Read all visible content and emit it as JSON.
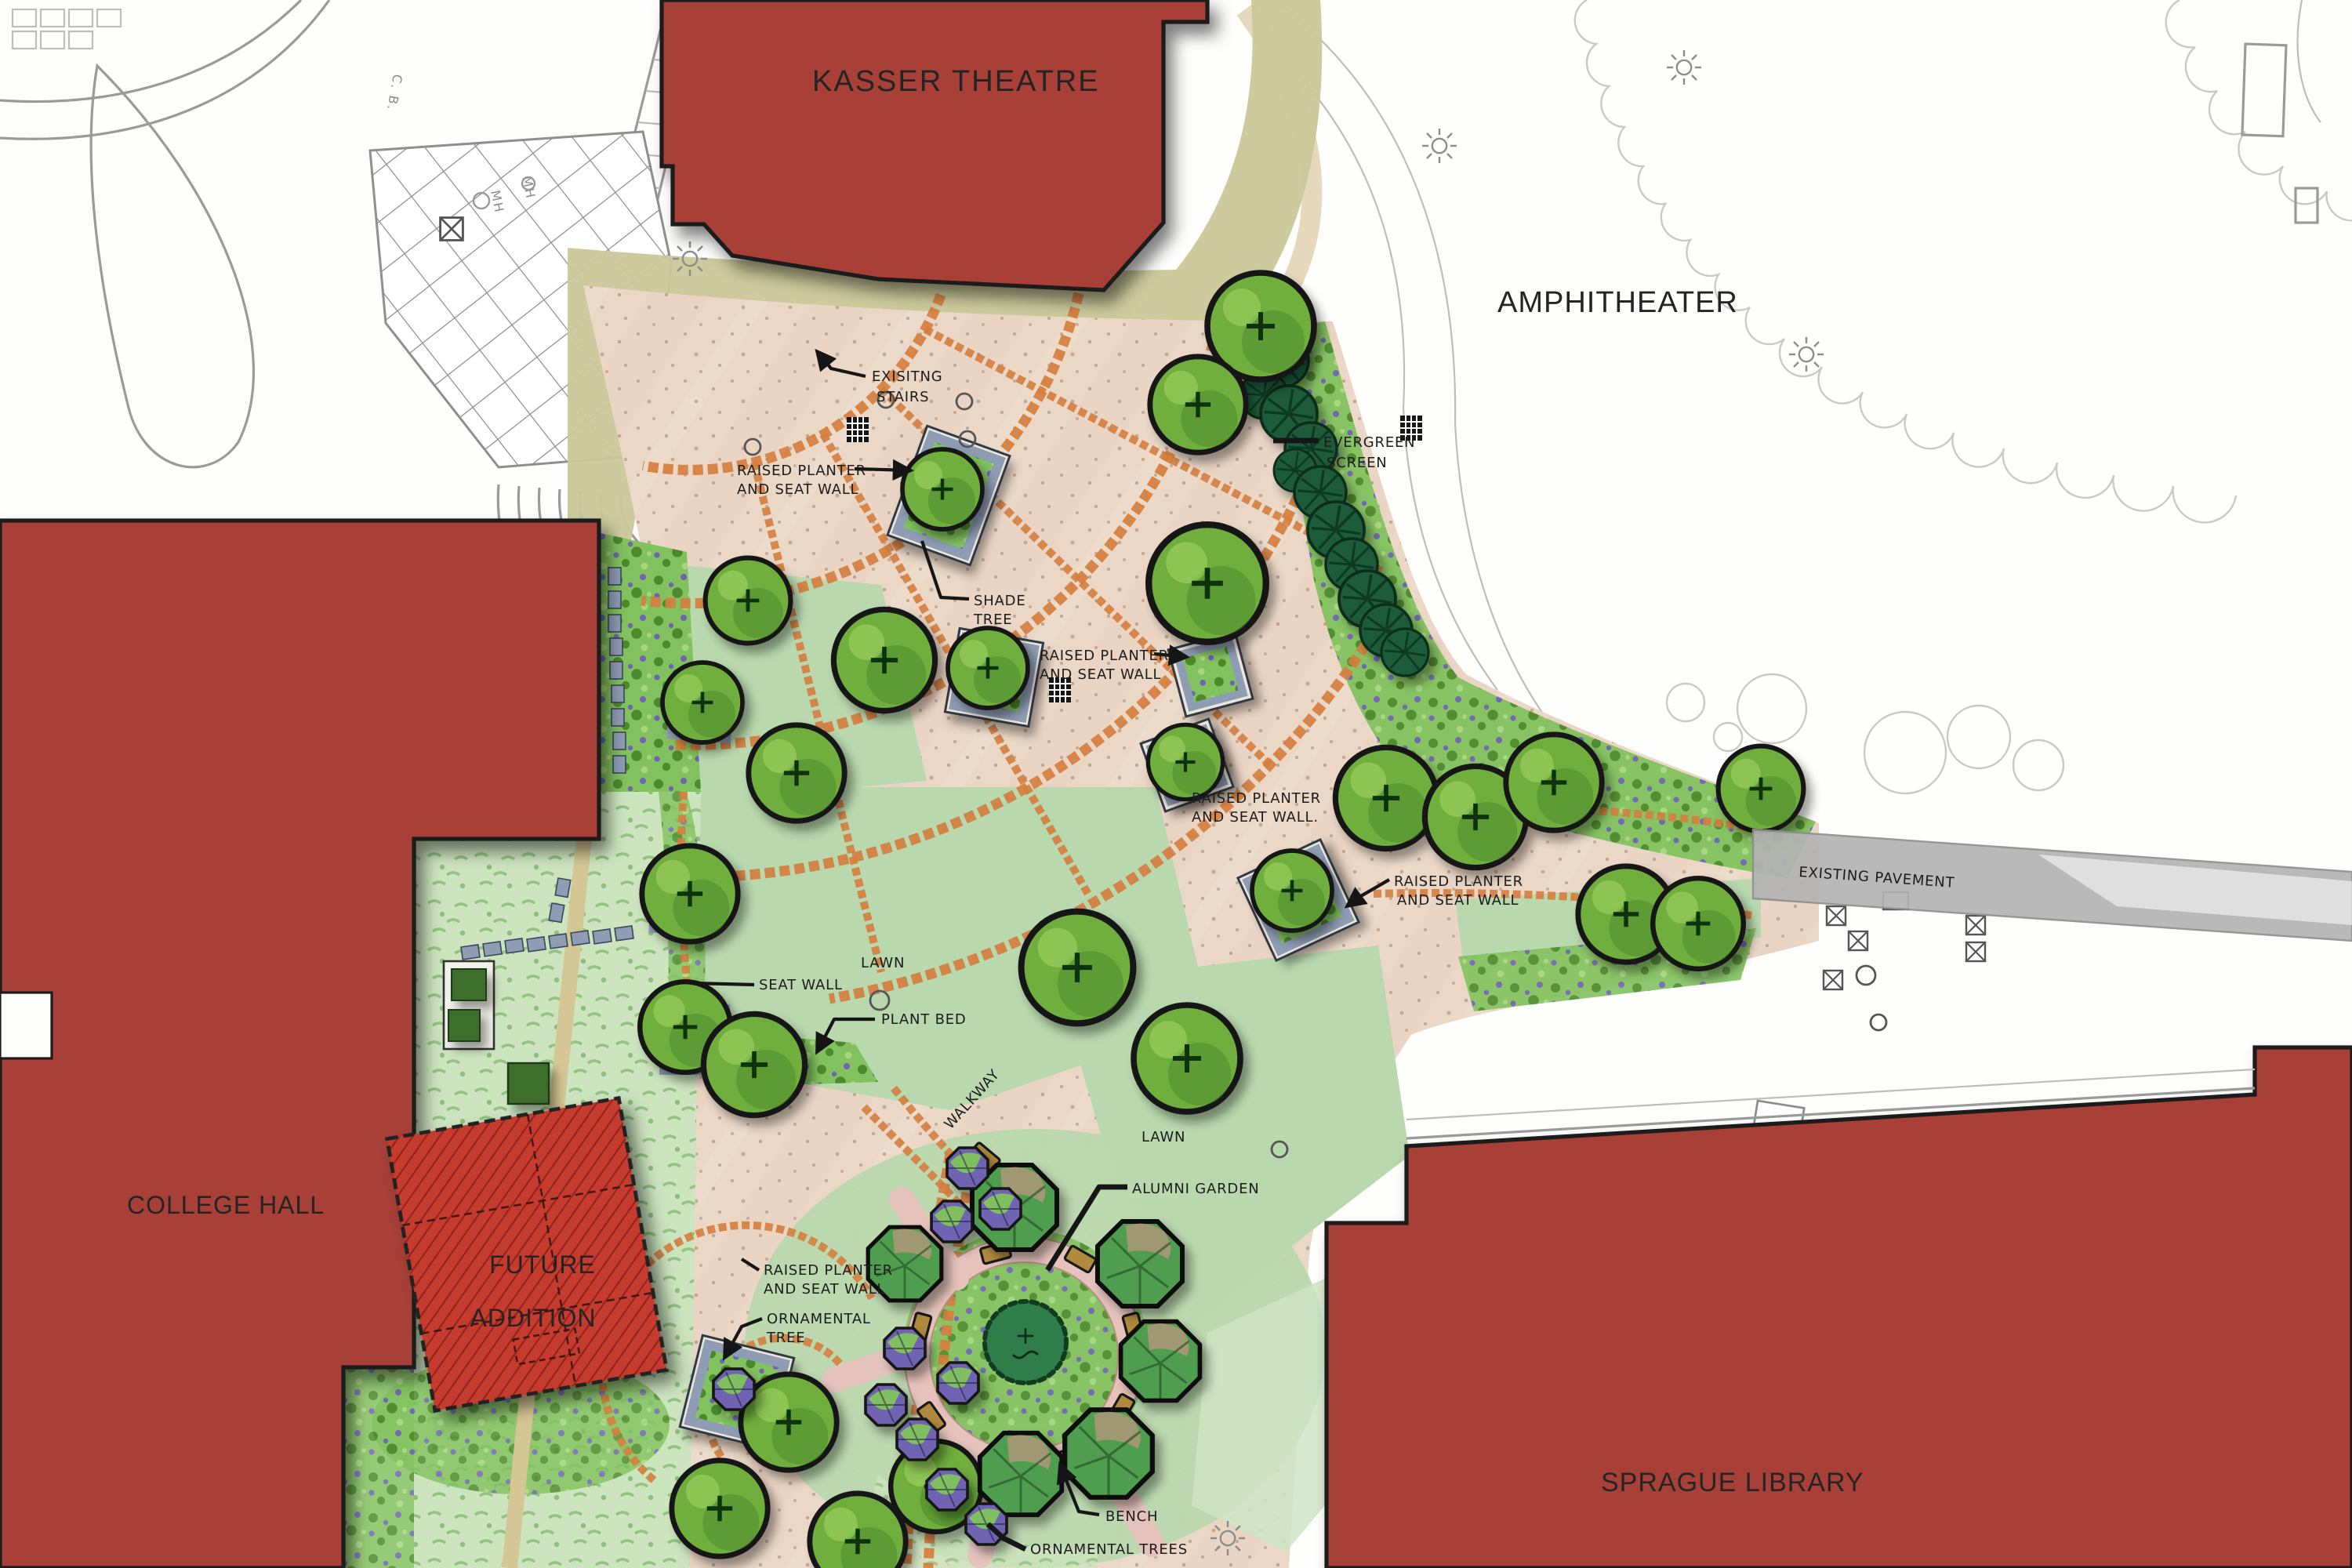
{
  "buildings": {
    "kasser_theatre": "KASSER THEATRE",
    "college_hall": "COLLEGE HALL",
    "future_addition": {
      "line1": "FUTURE",
      "line2": "ADDITION"
    },
    "sprague_library": "SPRAGUE LIBRARY"
  },
  "areas": {
    "amphitheater": "AMPHITHEATER",
    "existing_pavement": "EXISTING PAVEMENT",
    "lawn_upper": "LAWN",
    "lawn_lower": "LAWN",
    "walkway": "WALKWAY"
  },
  "callouts": {
    "existing_stairs": {
      "line1": "EXISITNG",
      "line2": "STAIRS"
    },
    "raised_planter_1": {
      "line1": "RAISED PLANTER",
      "line2": "AND SEAT WALL"
    },
    "shade_tree": {
      "line1": "SHADE",
      "line2": "TREE"
    },
    "raised_planter_2": {
      "line1": "RAISED PLANTER",
      "line2": "AND SEAT WALL"
    },
    "evergreen_screen": {
      "line1": "EVERGREEN",
      "line2": "SCREEN"
    },
    "raised_planter_3": {
      "line1": "RAISED PLANTER",
      "line2": "AND SEAT WALL."
    },
    "raised_planter_4": {
      "line1": "RAISED PLANTER",
      "line2": "AND SEAT WALL"
    },
    "seat_wall": "SEAT WALL",
    "plant_bed": "PLANT BED",
    "alumni_garden": "ALUMNI GARDEN",
    "raised_planter_5": {
      "line1": "RAISED PLANTER",
      "line2": "AND SEAT WALL"
    },
    "ornamental_tree": {
      "line1": "ORNAMENTAL",
      "line2": "TREE"
    },
    "bench": "BENCH",
    "ornamental_trees": "ORNAMENTAL TREES"
  },
  "survey_marks": {
    "cb": "C. B.",
    "mh_1": "MH",
    "mh_2": "MH"
  },
  "colors": {
    "building_red": "#a84038",
    "future_red": "#c53b2e",
    "brick_orange": "#d57e3e",
    "paving_tan": "#ead7c6",
    "paving_pink": "#e9c9ba",
    "lawn_green": "#b9d8ae",
    "meadow_green": "#cde5bf",
    "planting_green": "#82c25e",
    "tree_green": "#6fae3e",
    "tree_dark": "#4c8a2b",
    "evergreen_green": "#1e5c3a",
    "planter_blue": "#8e9cb4",
    "ornamental_purple": "#6f63b2",
    "khaki_green": "#cac898",
    "pavement_gray": "#b3b3b3",
    "bench_brown": "#b08a3e",
    "garden_ring_pink": "#e5c3bc",
    "ink": "#1b1b1b",
    "linework_gray": "#9a9a9a"
  }
}
